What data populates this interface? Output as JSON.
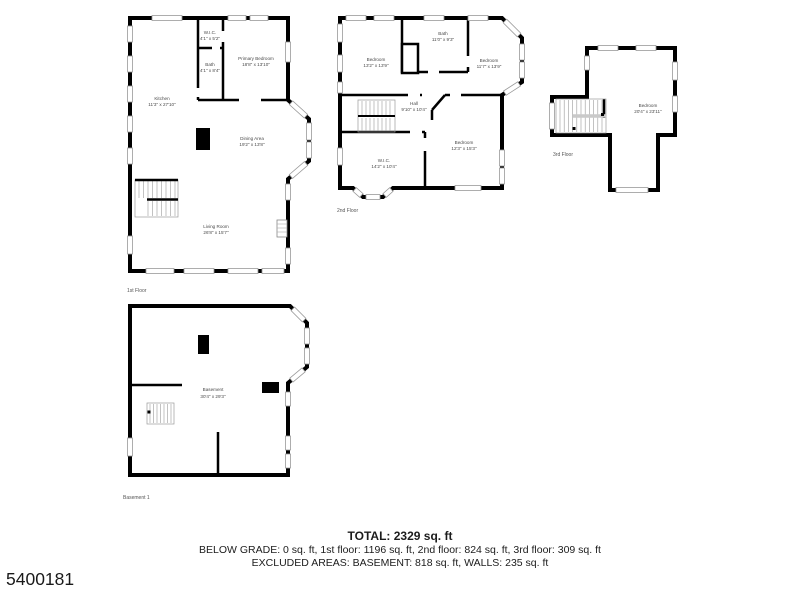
{
  "photo_id": "5400181",
  "summary": {
    "total": "TOTAL: 2329 sq. ft",
    "by_floor": "BELOW GRADE: 0 sq. ft, 1st floor: 1196 sq. ft, 2nd floor: 824 sq. ft, 3rd floor: 309 sq. ft",
    "excluded": "EXCLUDED AREAS: BASEMENT: 818 sq. ft, WALLS: 235 sq. ft"
  },
  "floors": {
    "first": {
      "label": "1st Floor",
      "rooms": {
        "wic": {
          "name": "W.I.C.",
          "dims": "4'1\" x 5'2\""
        },
        "bath": {
          "name": "Bath",
          "dims": "4'1\" x 8'4\""
        },
        "primary_bedroom": {
          "name": "Primary Bedroom",
          "dims": "18'8\" x 13'10\""
        },
        "kitchen": {
          "name": "Kitchen",
          "dims": "11'3\" x 27'10\""
        },
        "dining": {
          "name": "Dining Area",
          "dims": "19'2\" x 13'8\""
        },
        "living": {
          "name": "Living Room",
          "dims": "26'8\" x 15'7\""
        }
      }
    },
    "second": {
      "label": "2nd Floor",
      "rooms": {
        "bedroom_left": {
          "name": "Bedroom",
          "dims": "13'2\" x 13'9\""
        },
        "bath": {
          "name": "Bath",
          "dims": "11'0\" x 9'3\""
        },
        "bedroom_right": {
          "name": "Bedroom",
          "dims": "11'7\" x 13'9\""
        },
        "hall": {
          "name": "Hall",
          "dims": "9'10\" x 10'4\""
        },
        "wic": {
          "name": "W.I.C.",
          "dims": "14'2\" x 10'4\""
        },
        "bedroom_bottom": {
          "name": "Bedroom",
          "dims": "12'3\" x 15'3\""
        }
      }
    },
    "third": {
      "label": "3rd Floor",
      "rooms": {
        "bedroom": {
          "name": "Bedroom",
          "dims": "20'4\" x 23'11\""
        }
      }
    },
    "basement": {
      "label": "Basement 1",
      "rooms": {
        "main": {
          "name": "Basement",
          "dims": "30'4\" x 29'3\""
        }
      }
    }
  },
  "colors": {
    "wall": "#000000",
    "window_trim": "#999999",
    "stairs": "#9a9a9a",
    "room_label": "#4a4a4a",
    "summary_text": "#1c1c1c"
  }
}
